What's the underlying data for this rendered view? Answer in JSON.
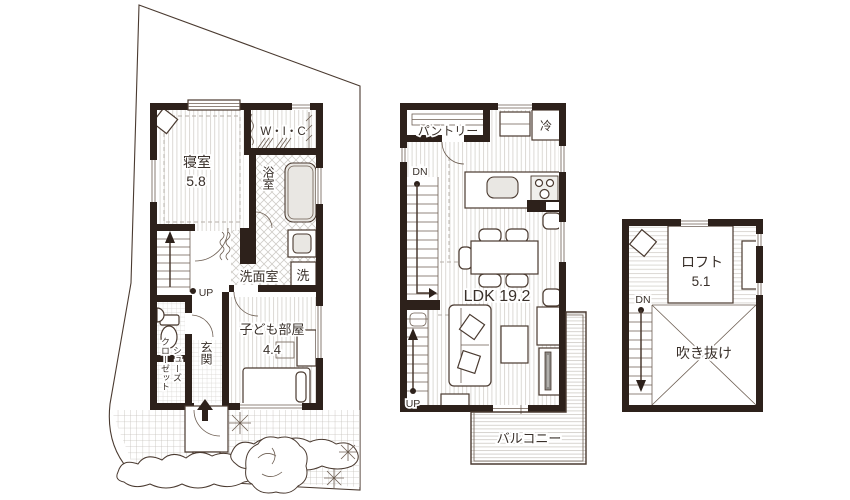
{
  "colors": {
    "wall": "#2d211b",
    "line": "#4a3a30",
    "floor_stripe": "#dcd9d5",
    "fixture_gray": "#e9e7e3"
  },
  "floor1": {
    "bedroom_name": "寝室",
    "bedroom_area": "5.8",
    "wic": "W・I・C",
    "bath": "浴室",
    "washroom": "洗面室",
    "laundry": "洗",
    "kids_name": "子ども部屋",
    "kids_area": "4.4",
    "entrance": "玄関",
    "shoe_closet_line1": "シューズ",
    "shoe_closet_line2": "クローゼット",
    "stairs_up": "UP"
  },
  "floor2": {
    "pantry": "パントリー",
    "fridge": "冷",
    "ldk": "LDK 19.2",
    "balcony": "バルコニー",
    "stairs_down": "DN",
    "stairs_up": "UP"
  },
  "loft": {
    "name": "ロフト",
    "area": "5.1",
    "void": "吹き抜け",
    "stairs_down": "DN"
  }
}
